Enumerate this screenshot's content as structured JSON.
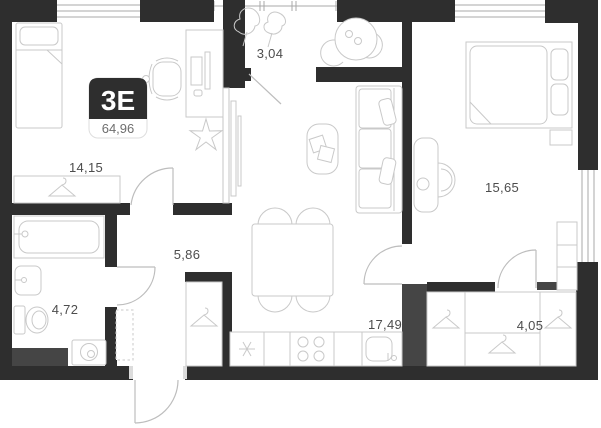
{
  "plan": {
    "badge": {
      "type_label": "3E",
      "total_area": "64,96"
    },
    "rooms": [
      {
        "id": "bedroom-left",
        "area": "14,15"
      },
      {
        "id": "balcony",
        "area": "3,04"
      },
      {
        "id": "hallway",
        "area": "5,86"
      },
      {
        "id": "bathroom",
        "area": "4,72"
      },
      {
        "id": "kitchen-living",
        "area": "17,49"
      },
      {
        "id": "bedroom-right",
        "area": "15,65"
      },
      {
        "id": "wardrobe",
        "area": "4,05"
      }
    ],
    "colors": {
      "wall": "#2e2e2e",
      "shaft": "#454545",
      "furniture_line": "#c9c9c9",
      "label_text": "#4d4d4d",
      "badge_background": "#2e2e2e",
      "badge_area_text": "#6e6e6e",
      "background": "#ffffff"
    },
    "icons": [
      "single-bed",
      "double-bed",
      "pillow",
      "wardrobe-hanger",
      "desk",
      "monitor",
      "office-chair",
      "flower-plant",
      "balcony-plant",
      "round-table",
      "chair",
      "tv",
      "sofa",
      "coffee-table",
      "dining-table",
      "kitchen-counter",
      "extractor-asterisk",
      "stove",
      "kitchen-sink",
      "bathtub",
      "washbasin",
      "toilet",
      "washing-machine",
      "shoe-cabinet",
      "shelf",
      "door-arc"
    ]
  }
}
